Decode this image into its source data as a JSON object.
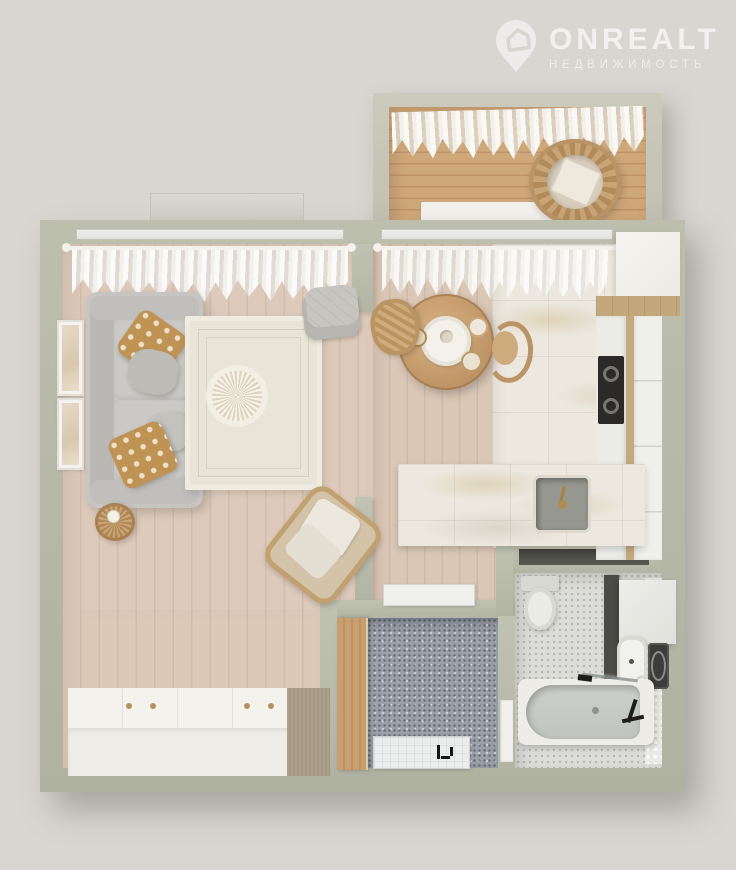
{
  "logo": {
    "brand": "ONREALT",
    "tagline": "НЕДВИЖИМОСТЬ",
    "icon": "house-pin-icon"
  },
  "scene": {
    "type": "3d-floor-plan-top-view",
    "rooms": [
      {
        "name": "living-room",
        "items": [
          "gray sofa",
          "patterned tan pillows",
          "gray pillows",
          "cream area rug with round medallion",
          "round wicker side table",
          "two wall picture frames",
          "sheer window curtains with rod",
          "stacked gray floor cushions",
          "rattan armchair with white cushions",
          "white wardrobe with gold knobs and tan end section"
        ]
      },
      {
        "name": "kitchen-dining",
        "items": [
          "round wooden dining table",
          "white centerpiece with vase",
          "table setting dishes",
          "two rattan chairs",
          "sheer window curtains with rod",
          "refrigerator",
          "tall white cabinets",
          "black cooktop",
          "white counter",
          "marble peninsula counter with gray sink and gold faucet",
          "white threshold mat",
          "marble tile floor",
          "wood plank floor"
        ]
      },
      {
        "name": "balcony",
        "items": [
          "sheer curtain",
          "hanging rattan egg chair with cushion",
          "white window bench",
          "orange wood deck floor"
        ]
      },
      {
        "name": "hallway",
        "items": [
          "tall wooden cabinet",
          "entrance doormat with black motif",
          "blue speckled tile floor",
          "white bathroom door"
        ]
      },
      {
        "name": "bathroom",
        "items": [
          "toilet with tank",
          "dark counter strip",
          "white wall cabinet",
          "white washbasin",
          "washing machine",
          "toilet paper roll",
          "bathtub with gray interior",
          "glass screen",
          "black shower fixture",
          "light mosaic tile floor"
        ]
      }
    ]
  },
  "colors": {
    "background": "#d9d6d1",
    "walls": "#b5b7a7",
    "living_wood_floor": "#ddcabb",
    "balcony_wood_floor": "#c9a274",
    "marble_floor": "#ece8df",
    "hall_tile": "#99a0a9",
    "bath_mosaic": "#dcddd8",
    "sofa_gray": "#c6c5c1",
    "accent_tan_pillow": "#bf9354",
    "rattan": "#ba9463",
    "gold_hardware": "#b5925d",
    "white_furniture": "#f2f0eb",
    "cooktop_black": "#2b2a28",
    "logo_white": "rgba(255,255,255,0.6)"
  }
}
